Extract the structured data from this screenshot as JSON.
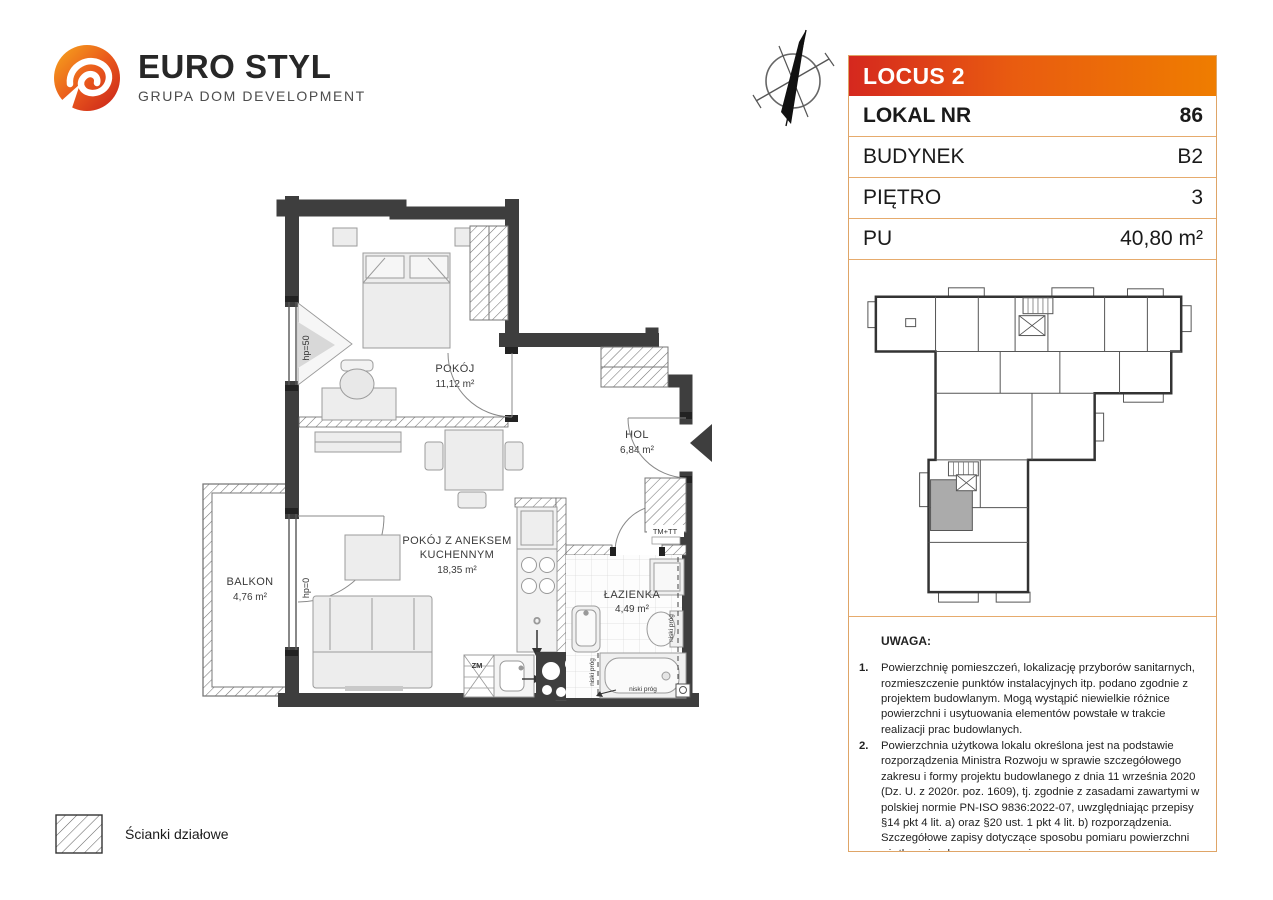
{
  "brand": {
    "name": "EURO STYL",
    "subtitle": "GRUPA DOM DEVELOPMENT"
  },
  "info_table": {
    "header": "LOCUS 2",
    "rows": [
      {
        "label": "LOKAL NR",
        "value": "86"
      },
      {
        "label": "BUDYNEK",
        "value": "B2"
      },
      {
        "label": "PIĘTRO",
        "value": "3"
      },
      {
        "label": "PU",
        "value": "40,80 m²"
      }
    ]
  },
  "floor_plan": {
    "rooms": [
      {
        "name": "POKÓJ",
        "area": "11,12 m²"
      },
      {
        "name": "HOL",
        "area": "6,84 m²"
      },
      {
        "name": "POKÓJ Z ANEKSEM KUCHENNYM",
        "name_line1": "POKÓJ Z ANEKSEM",
        "name_line2": "KUCHENNYM",
        "area": "18,35 m²"
      },
      {
        "name": "ŁAZIENKA",
        "area": "4,49 m²"
      },
      {
        "name": "BALKON",
        "area": "4,76 m²"
      }
    ],
    "annotations": {
      "window_height": "hp=50",
      "balcony_door_height": "hp=0",
      "tm_tt": "TM+TT",
      "zm": "ZM",
      "niski_prog": "niski próg",
      "vent": "O"
    }
  },
  "legend": {
    "label": "Ścianki działowe"
  },
  "notes": {
    "title": "UWAGA:",
    "nums": [
      "1.",
      "2.",
      "3."
    ],
    "items": [
      "Powierzchnię pomieszczeń, lokalizację przyborów sanitarnych, rozmieszczenie punktów instalacyjnych itp. podano zgodnie z projektem budowlanym. Mogą wystąpić niewielkie różnice powierzchni i usytuowania elementów powstałe w trakcie realizacji prac budowlanych.",
      "Powierzchnia użytkowa lokalu określona jest na podstawie rozporządzenia Ministra Rozwoju w sprawie szczegółowego zakresu i formy projektu budowlanego z dnia 11 września 2020 (Dz. U. z 2020r. poz. 1609), tj. zgodnie z zasadami zawartymi w polskiej normie PN-ISO 9836:2022-07, uwzględniając przepisy §14 pkt 4 lit. a) oraz §20 ust. 1 pkt 4 lit. b) rozporządzenia. Szczegółowe zapisy dotyczące sposobu pomiaru powierzchni użytkowej wskazano w umowie.",
      "Przedstawiona na rzucie aranżacja ma charakter przykładowy, umeblowanie i zabudowy instalacyjne nie stanowią wyposażenia nabywanego lokalu"
    ]
  },
  "colors": {
    "accent_red": "#d5281e",
    "accent_orange": "#ef7d00",
    "panel_border": "#dfa567",
    "wall": "#3e3e3e",
    "minimap_highlight": "#ababab"
  }
}
